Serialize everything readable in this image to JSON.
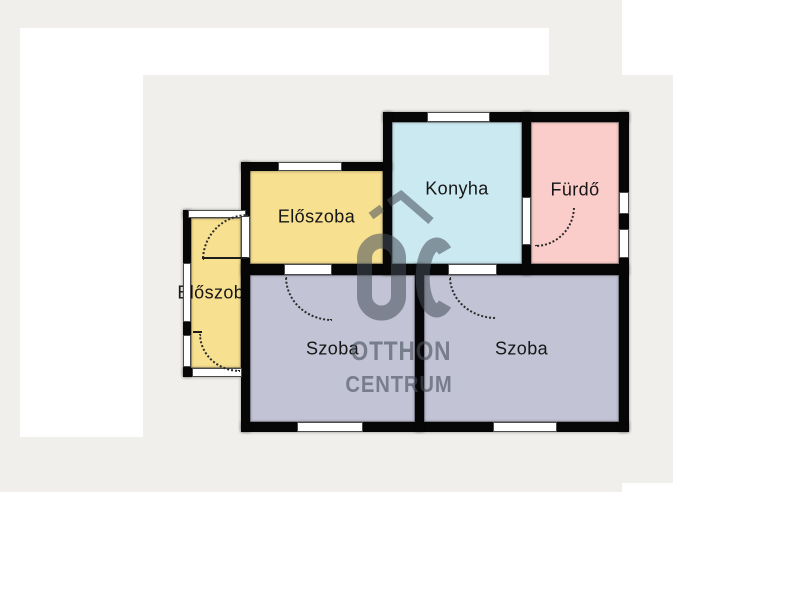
{
  "page": {
    "background": "#ffffff",
    "canvas_color": "#f0efeb"
  },
  "floorplan": {
    "wall_color": "#060606",
    "rooms": [
      {
        "id": "eloszoba-main",
        "label": "Előszoba",
        "color": "#f7e08f"
      },
      {
        "id": "eloszoba-side",
        "label": "Előszoba",
        "color": "#f7e08f"
      },
      {
        "id": "konyha",
        "label": "Konyha",
        "color": "#cbe9f0"
      },
      {
        "id": "furdo",
        "label": "Fürdő",
        "color": "#fbcdca"
      },
      {
        "id": "szoba-left",
        "label": "Szoba",
        "color": "#c2c3d5"
      },
      {
        "id": "szoba-right",
        "label": "Szoba",
        "color": "#c2c3d5"
      }
    ]
  },
  "watermark": {
    "monogram": "OC",
    "line1": "OTTHON",
    "line2": "CENTRUM",
    "color": "#5a6470"
  }
}
